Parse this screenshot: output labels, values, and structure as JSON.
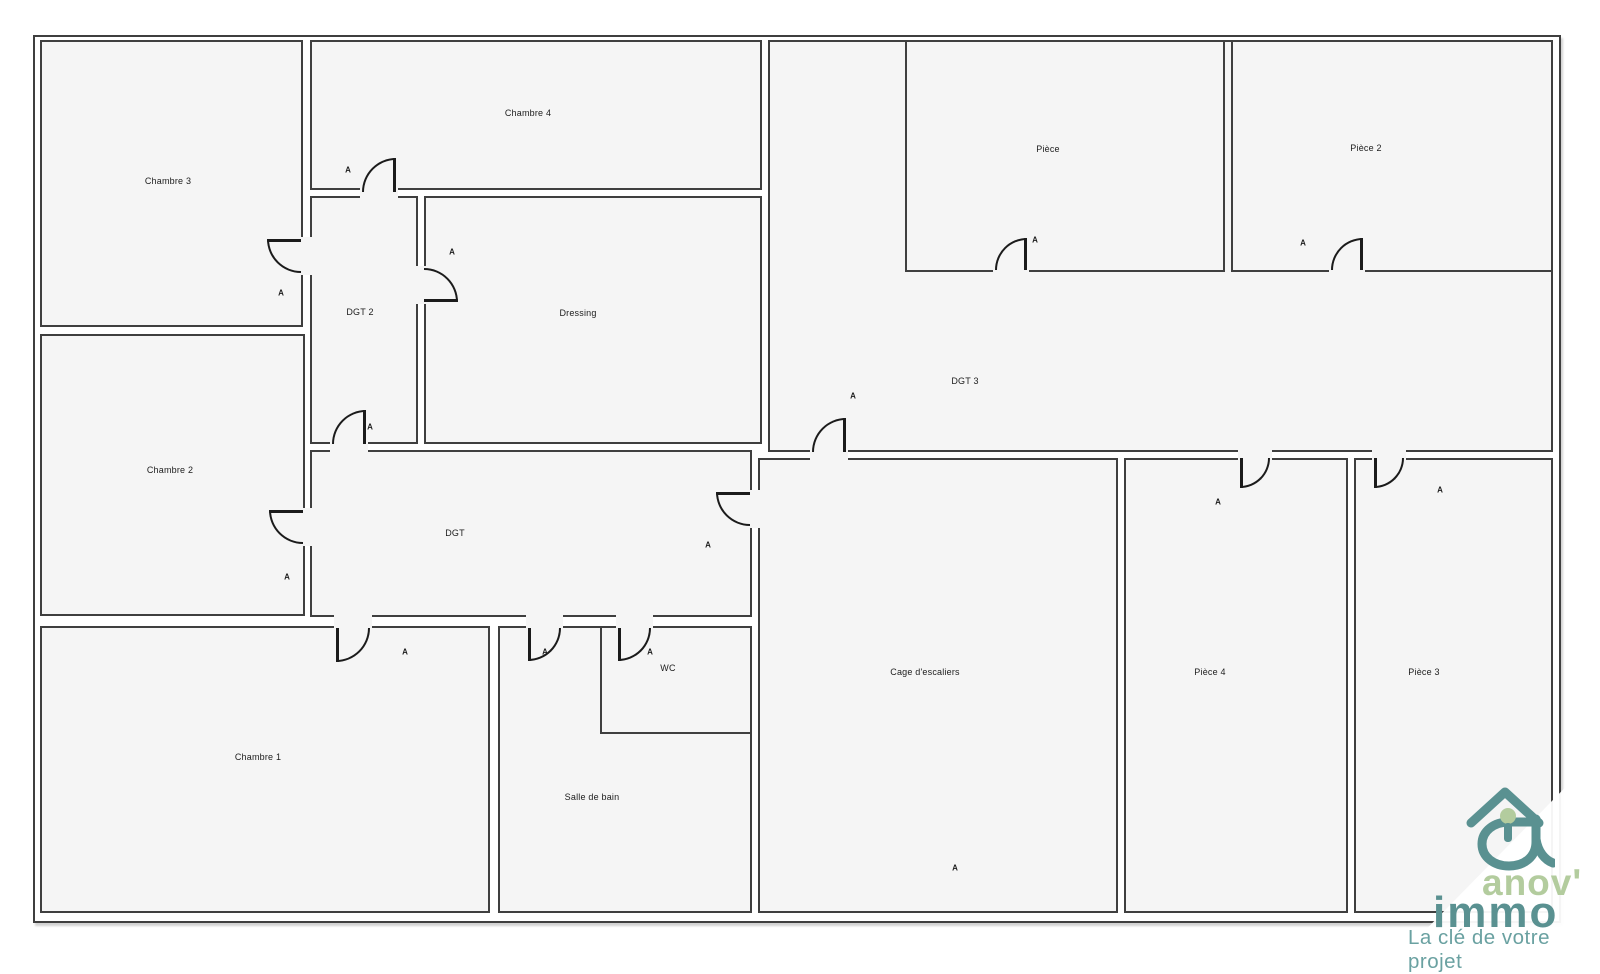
{
  "plan": {
    "outline": {
      "x": 33,
      "y": 35,
      "w": 1524,
      "h": 884
    },
    "wall_color": "#3f3f3f",
    "door_color": "#1b1b1b",
    "room_fill": "#f5f5f5",
    "door_marker_label": "A",
    "rooms": [
      {
        "id": "chambre-3",
        "label": "Chambre 3",
        "x": 40,
        "y": 40,
        "w": 263,
        "h": 287,
        "lx": 168,
        "ly": 181
      },
      {
        "id": "chambre-2",
        "label": "Chambre 2",
        "x": 40,
        "y": 334,
        "w": 265,
        "h": 282,
        "lx": 170,
        "ly": 470
      },
      {
        "id": "chambre-1",
        "label": "Chambre 1",
        "x": 40,
        "y": 626,
        "w": 450,
        "h": 287,
        "lx": 258,
        "ly": 757
      },
      {
        "id": "chambre-4",
        "label": "Chambre 4",
        "x": 310,
        "y": 40,
        "w": 452,
        "h": 150,
        "lx": 528,
        "ly": 113
      },
      {
        "id": "dgt-2",
        "label": "DGT 2",
        "x": 310,
        "y": 196,
        "w": 108,
        "h": 248,
        "lx": 360,
        "ly": 312
      },
      {
        "id": "dressing",
        "label": "Dressing",
        "x": 424,
        "y": 196,
        "w": 338,
        "h": 248,
        "lx": 578,
        "ly": 313
      },
      {
        "id": "dgt",
        "label": "DGT",
        "x": 310,
        "y": 450,
        "w": 442,
        "h": 167,
        "lx": 455,
        "ly": 533
      },
      {
        "id": "dgt-3",
        "label": "DGT 3",
        "x": 768,
        "y": 40,
        "w": 785,
        "h": 412,
        "lx": 965,
        "ly": 381
      },
      {
        "id": "piece",
        "label": "Pièce",
        "x": 905,
        "y": 40,
        "w": 320,
        "h": 232,
        "lx": 1048,
        "ly": 149
      },
      {
        "id": "piece-2",
        "label": "Pièce 2",
        "x": 1231,
        "y": 40,
        "w": 322,
        "h": 232,
        "lx": 1366,
        "ly": 148
      },
      {
        "id": "salle-de-bain",
        "label": "Salle de bain",
        "x": 498,
        "y": 626,
        "w": 254,
        "h": 287,
        "lx": 592,
        "ly": 797
      },
      {
        "id": "wc",
        "label": "WC",
        "x": 600,
        "y": 626,
        "w": 152,
        "h": 108,
        "lx": 668,
        "ly": 668
      },
      {
        "id": "cage-escaliers",
        "label": "Cage d'escaliers",
        "x": 758,
        "y": 458,
        "w": 360,
        "h": 455,
        "lx": 925,
        "ly": 672
      },
      {
        "id": "piece-4",
        "label": "Pièce 4",
        "x": 1124,
        "y": 458,
        "w": 224,
        "h": 455,
        "lx": 1210,
        "ly": 672
      },
      {
        "id": "piece-3",
        "label": "Pièce 3",
        "x": 1354,
        "y": 458,
        "w": 199,
        "h": 455,
        "lx": 1424,
        "ly": 672
      }
    ],
    "doors": [
      {
        "id": "door-chambre-3",
        "x": 267,
        "y": 239,
        "w": 34,
        "h": 34,
        "corner": "bl",
        "leaf": "top",
        "ox": 299,
        "oy": 237,
        "ow": 14,
        "oh": 38
      },
      {
        "id": "door-chambre-4",
        "x": 362,
        "y": 158,
        "w": 34,
        "h": 34,
        "corner": "tl",
        "leaf": "right",
        "ox": 360,
        "oy": 186,
        "ow": 38,
        "oh": 12
      },
      {
        "id": "door-dressing",
        "x": 424,
        "y": 268,
        "w": 34,
        "h": 34,
        "corner": "tr",
        "leaf": "bottom",
        "ox": 414,
        "oy": 266,
        "ow": 12,
        "oh": 38
      },
      {
        "id": "door-dgt-2",
        "x": 332,
        "y": 410,
        "w": 34,
        "h": 34,
        "corner": "tl",
        "leaf": "right",
        "ox": 330,
        "oy": 440,
        "ow": 38,
        "oh": 12
      },
      {
        "id": "door-chambre-2",
        "x": 269,
        "y": 510,
        "w": 34,
        "h": 34,
        "corner": "bl",
        "leaf": "top",
        "ox": 303,
        "oy": 508,
        "ow": 12,
        "oh": 38
      },
      {
        "id": "door-dgt",
        "x": 716,
        "y": 492,
        "w": 34,
        "h": 34,
        "corner": "bl",
        "leaf": "top",
        "ox": 748,
        "oy": 490,
        "ow": 12,
        "oh": 38
      },
      {
        "id": "door-dgt-3",
        "x": 812,
        "y": 418,
        "w": 34,
        "h": 34,
        "corner": "tl",
        "leaf": "right",
        "ox": 810,
        "oy": 448,
        "ow": 38,
        "oh": 12
      },
      {
        "id": "door-chambre-1",
        "x": 336,
        "y": 628,
        "w": 34,
        "h": 34,
        "corner": "br",
        "leaf": "left",
        "ox": 334,
        "oy": 613,
        "ow": 38,
        "oh": 15
      },
      {
        "id": "door-salle-de-bain",
        "x": 528,
        "y": 628,
        "w": 33,
        "h": 33,
        "corner": "br",
        "leaf": "left",
        "ox": 526,
        "oy": 613,
        "ow": 37,
        "oh": 15
      },
      {
        "id": "door-wc",
        "x": 618,
        "y": 628,
        "w": 33,
        "h": 33,
        "corner": "br",
        "leaf": "left",
        "ox": 616,
        "oy": 613,
        "ow": 37,
        "oh": 15
      },
      {
        "id": "door-piece",
        "x": 995,
        "y": 238,
        "w": 32,
        "h": 32,
        "corner": "tl",
        "leaf": "right",
        "ox": 993,
        "oy": 266,
        "ow": 36,
        "oh": 8
      },
      {
        "id": "door-piece-2",
        "x": 1331,
        "y": 238,
        "w": 32,
        "h": 32,
        "corner": "tl",
        "leaf": "right",
        "ox": 1329,
        "oy": 266,
        "ow": 36,
        "oh": 8
      },
      {
        "id": "door-piece-4",
        "x": 1240,
        "y": 458,
        "w": 30,
        "h": 30,
        "corner": "br",
        "leaf": "left",
        "ox": 1238,
        "oy": 448,
        "ow": 34,
        "oh": 12
      },
      {
        "id": "door-piece-3",
        "x": 1374,
        "y": 458,
        "w": 30,
        "h": 30,
        "corner": "br",
        "leaf": "left",
        "ox": 1372,
        "oy": 448,
        "ow": 34,
        "oh": 12
      }
    ],
    "door_markers": [
      {
        "x": 348,
        "y": 170
      },
      {
        "x": 281,
        "y": 293
      },
      {
        "x": 452,
        "y": 252
      },
      {
        "x": 370,
        "y": 427
      },
      {
        "x": 287,
        "y": 577
      },
      {
        "x": 708,
        "y": 545
      },
      {
        "x": 853,
        "y": 396
      },
      {
        "x": 405,
        "y": 652
      },
      {
        "x": 545,
        "y": 652
      },
      {
        "x": 650,
        "y": 652
      },
      {
        "x": 1035,
        "y": 240
      },
      {
        "x": 1303,
        "y": 243
      },
      {
        "x": 1218,
        "y": 502
      },
      {
        "x": 1440,
        "y": 490
      },
      {
        "x": 955,
        "y": 868
      }
    ]
  },
  "logo": {
    "brand_top": "anov'",
    "brand_bottom": "immo",
    "tagline": "La clé de votre projet",
    "color_green": "#b3cc9e",
    "color_teal": "#5a9191",
    "color_tagline": "#6aa1a1"
  }
}
